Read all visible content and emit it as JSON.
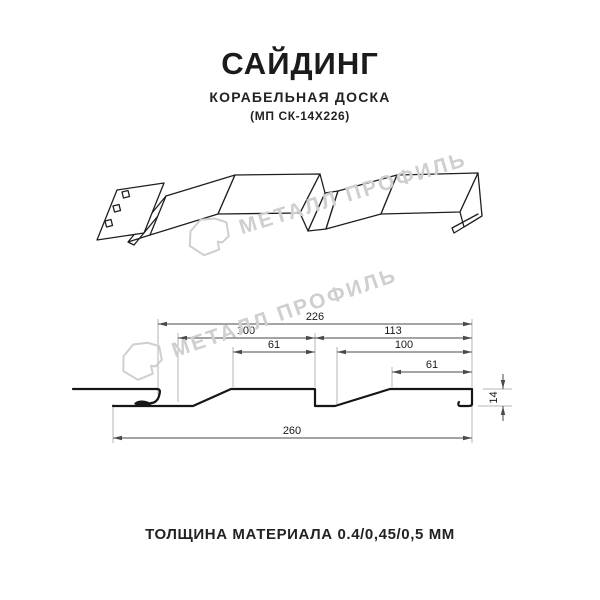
{
  "header": {
    "title": "САЙДИНГ",
    "subtitle": "КОРАБЕЛЬНАЯ ДОСКА",
    "model": "(МП СК-14Х226)"
  },
  "watermark": {
    "brand": "МЕТАЛЛ ПРОФИЛЬ",
    "color": "#cfcfcf"
  },
  "section_drawing": {
    "dims": {
      "overall_top": "226",
      "panel_left": "100",
      "panel_right": "113",
      "flat_left": "61",
      "inner_right": "100",
      "flat_right": "61",
      "overall_bottom": "260",
      "height": "14"
    }
  },
  "footer": {
    "thickness": "ТОЛЩИНА МАТЕРИАЛА 0.4/0,45/0,5 ММ"
  }
}
